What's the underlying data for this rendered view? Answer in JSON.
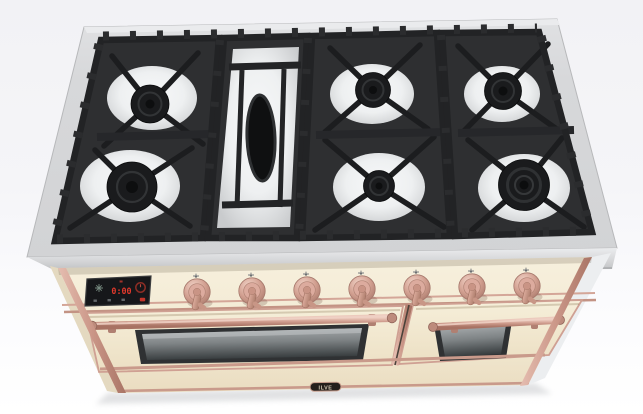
{
  "product": {
    "category": "freestanding dual-fuel range cooker, top-front 3/4 render",
    "brand_badge": "ILVE",
    "finish": {
      "body_cream": "#f4ecd7",
      "copper_trim": "#d0a094",
      "cooktop_steel": "#d8d9db",
      "grate_black": "#2b2c2e",
      "enamel_white": "#f1f2f4"
    }
  },
  "cooktop": {
    "grate_sections": 4,
    "griddle": {
      "position": "center-left",
      "shape": "oval",
      "color": "#0f1011"
    },
    "burners": [
      {
        "position": "rear-left",
        "size": "medium"
      },
      {
        "position": "front-left",
        "size": "large"
      },
      {
        "position": "rear-center",
        "size": "medium"
      },
      {
        "position": "front-center",
        "size": "small"
      },
      {
        "position": "rear-right",
        "size": "medium"
      },
      {
        "position": "front-right",
        "size": "extra-large-multi-ring"
      }
    ]
  },
  "control_panel": {
    "display": {
      "clock": "0:00",
      "accent_red": "#e2392c",
      "left_icon": "defrost-icon",
      "right_icon": "temperature-dial-icon",
      "status_icons": [
        "light-icon",
        "timer-icon",
        "mode-icon",
        "power-icon"
      ]
    },
    "knobs": [
      {
        "id": 1,
        "indicator": "burner-position-mark"
      },
      {
        "id": 2,
        "indicator": "burner-position-mark"
      },
      {
        "id": 3,
        "indicator": "burner-position-mark"
      },
      {
        "id": 4,
        "indicator": "burner-position-mark"
      },
      {
        "id": 5,
        "indicator": "burner-position-mark"
      },
      {
        "id": 6,
        "indicator": "burner-position-mark"
      },
      {
        "id": 7,
        "indicator": "burner-position-mark"
      }
    ],
    "knob_color": "#d0a094"
  },
  "ovens": {
    "left": {
      "handle": "copper rail",
      "window": "tinted glass"
    },
    "right": {
      "handle": "copper rail",
      "window": "tinted glass"
    }
  },
  "lower_panel": {
    "badge_text": "ILVE"
  }
}
